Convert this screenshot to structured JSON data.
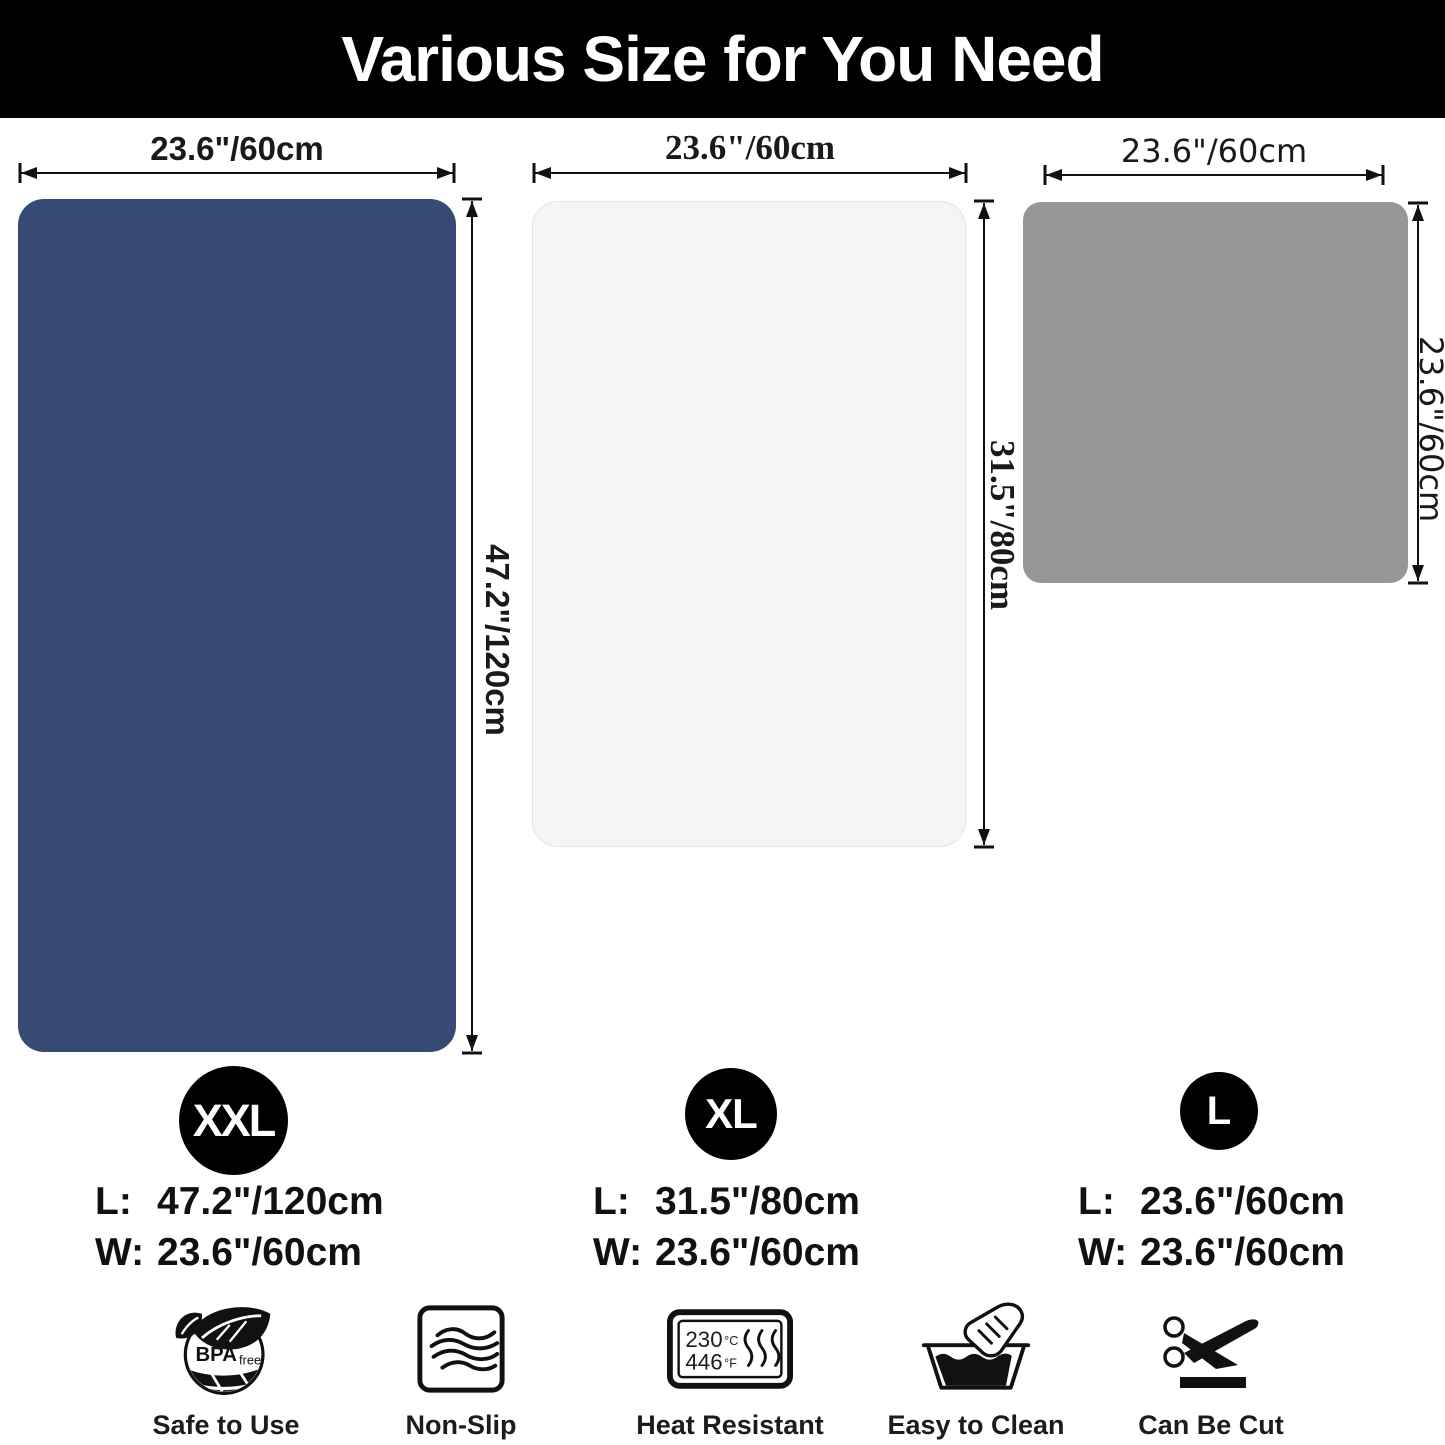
{
  "header": {
    "title": "Various Size for You Need"
  },
  "mats": [
    {
      "name": "XXL",
      "color": "#374a73",
      "top_label": "23.6\"/60cm",
      "side_label": "47.2\"/120cm"
    },
    {
      "name": "XL",
      "color": "#f5f5f6",
      "top_label": "23.6\"/60cm",
      "side_label": "31.5\"/80cm"
    },
    {
      "name": "L",
      "color": "#979797",
      "top_label": "23.6\"/60cm",
      "side_label": "23.6\"/60cm"
    }
  ],
  "sizes": [
    {
      "badge": "XXL",
      "rows": [
        {
          "label": "L:",
          "value": "47.2\"/120cm"
        },
        {
          "label": "W:",
          "value": "23.6\"/60cm"
        }
      ]
    },
    {
      "badge": "XL",
      "rows": [
        {
          "label": "L:",
          "value": "31.5\"/80cm"
        },
        {
          "label": "W:",
          "value": "23.6\"/60cm"
        }
      ]
    },
    {
      "badge": "L",
      "rows": [
        {
          "label": "L:",
          "value": "23.6\"/60cm"
        },
        {
          "label": "W:",
          "value": "23.6\"/60cm"
        }
      ]
    }
  ],
  "features": [
    {
      "icon": "bpa-free-icon",
      "label": "Safe to Use",
      "icon_text": "BPA",
      "icon_subtext": "free"
    },
    {
      "icon": "non-slip-icon",
      "label": "Non-Slip"
    },
    {
      "icon": "heat-resistant-icon",
      "label": "Heat Resistant",
      "celsius": "230",
      "celsius_unit": "°C",
      "fahrenheit": "446",
      "fahrenheit_unit": "°F"
    },
    {
      "icon": "easy-to-clean-icon",
      "label": "Easy to Clean"
    },
    {
      "icon": "can-be-cut-icon",
      "label": "Can Be Cut"
    }
  ]
}
